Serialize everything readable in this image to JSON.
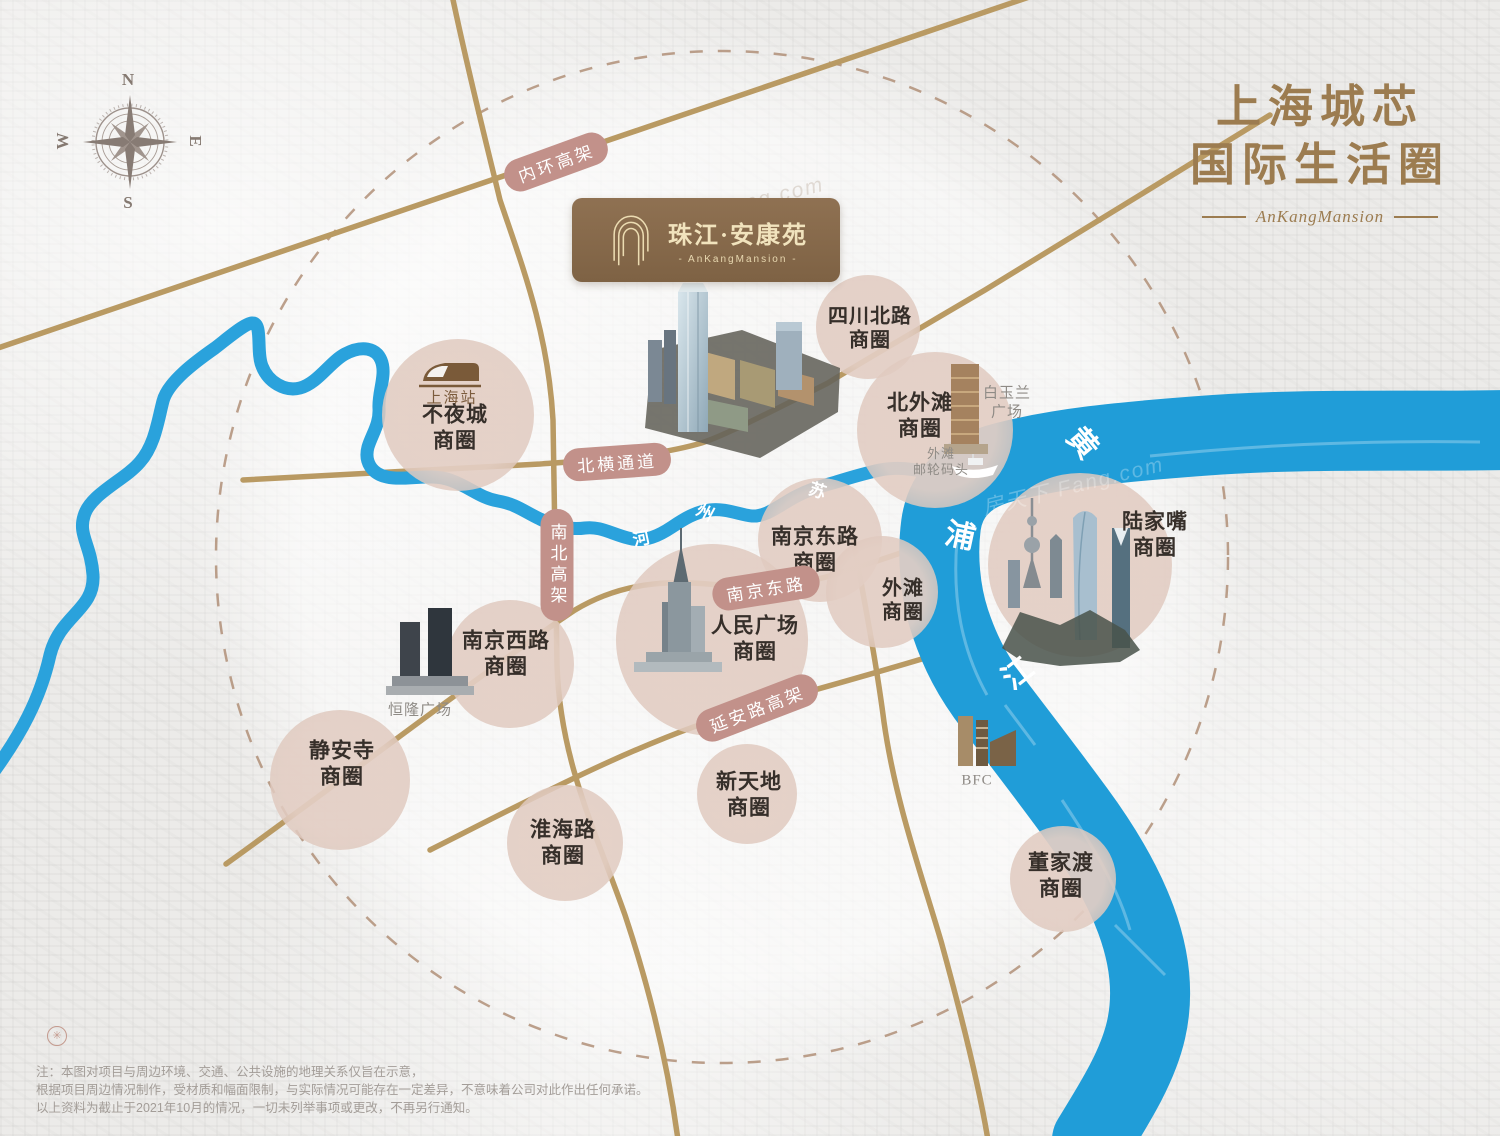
{
  "header": {
    "title_line1": "上海城芯",
    "title_line2": "国际生活圈",
    "subtitle": "AnKangMansion"
  },
  "brand": {
    "logo_icon": "arch-gate-icon",
    "logo_text": "珠江·安康苑",
    "logo_subtext": "- AnKangMansion -"
  },
  "compass": {
    "north": "N",
    "east": "E",
    "south": "S",
    "west": "W"
  },
  "districts": [
    {
      "id": "sichuanbeilu",
      "label": "四川北路\n商圈"
    },
    {
      "id": "buyecheng",
      "label": "不夜城\n商圈"
    },
    {
      "id": "beiwaitan",
      "label": "北外滩\n商圈"
    },
    {
      "id": "lujiazui",
      "label": "陆家嘴\n商圈"
    },
    {
      "id": "nanjingdonglu",
      "label": "南京东路\n商圈"
    },
    {
      "id": "waitan",
      "label": "外滩\n商圈"
    },
    {
      "id": "renminguangchang",
      "label": "人民广场\n商圈"
    },
    {
      "id": "nanjingxilu",
      "label": "南京西路\n商圈"
    },
    {
      "id": "jingansi",
      "label": "静安寺\n商圈"
    },
    {
      "id": "huaihailu",
      "label": "淮海路\n商圈"
    },
    {
      "id": "xintiandi",
      "label": "新天地\n商圈"
    },
    {
      "id": "dongjiadu",
      "label": "董家渡\n商圈"
    }
  ],
  "landmarks": [
    {
      "id": "shanghai-station",
      "label": "上海站",
      "icon": "train-icon"
    },
    {
      "id": "white-magnolia-plaza",
      "label": "白玉兰\n广场"
    },
    {
      "id": "bund-cruise-terminal",
      "label": "外滩\n邮轮码头",
      "icon": "ship-icon"
    },
    {
      "id": "plaza66",
      "label": "恒隆广场"
    },
    {
      "id": "bfc",
      "label": "BFC"
    }
  ],
  "roads": [
    {
      "id": "neihuan",
      "label": "内环高架"
    },
    {
      "id": "beiheng",
      "label": "北横通道"
    },
    {
      "id": "nanbei",
      "label": "南北高架"
    },
    {
      "id": "nanjingdong",
      "label": "南京东路"
    },
    {
      "id": "yanan",
      "label": "延安路高架"
    }
  ],
  "rivers": {
    "suzhou_name": "苏州河",
    "suzhou_chars": [
      "苏",
      "州",
      "河"
    ],
    "huangpu_name": "黄浦江",
    "huangpu_chars": [
      "黄",
      "浦",
      "江"
    ]
  },
  "watermark": "房天下 Fang.com",
  "disclaimer": [
    "注：本图对项目与周边环境、交通、公共设施的地理关系仅旨在示意，",
    "根据项目周边情况制作，受材质和幅面限制，与实际情况可能存在一定差异，不意味着公司对此作出任何承诺。",
    "以上资料为截止于2021年10月的情况，一切未列举事项或更改，不再另行通知。"
  ],
  "colors": {
    "accent_brown": "#9c7c50",
    "road_tan": "#b99a63",
    "road_pill": "#c2918a",
    "river_blue": "#219ed9",
    "bubble_pink": "#decabe",
    "label_dark": "#362f2a",
    "label_gray": "#8f8b86"
  }
}
